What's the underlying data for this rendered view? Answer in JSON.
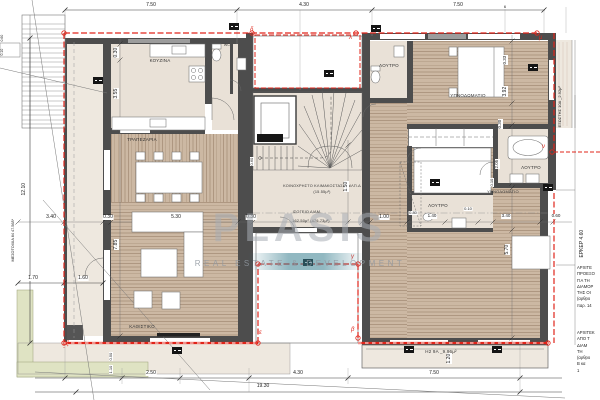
{
  "watermark": {
    "name": "PLASIS",
    "tagline": "REAL ESTATE & DEVELOPMENT"
  },
  "rooms": {
    "kitchen": "ΚΟΥΖΙΝΑ",
    "wc": "WC",
    "dining": "ΤΡΑΠΕΖΑΡΙΑ",
    "living": "ΚΑΘΙΣΤΙΚΟ",
    "bath1": "ΛΟΥΤΡΟ",
    "bath2": "ΛΟΥΤΡΟ",
    "bath3": "ΛΟΥΤΡΟ",
    "bedroom1": "ΥΠΝΟΔΩΜΑΤΙΟ",
    "bedroom2": "ΥΠΝΟΔΩΜΑΤΙΟ"
  },
  "areas": {
    "stair_line1": "ΚΟΙΝΟΧΡΗΣΤΟ ΚΛΙΜΑΚΟΣΤΑΣΙΟ ΚΛΠ.Δ",
    "stair_line2": "(15.55μ²)",
    "floor_line1": "ΙΣΟΓΕΙΟ ΔΙΑΜ.",
    "floor_line2": "162.50μ² (479.73μ²)",
    "balcony_east": "ΕΞΩΣΤΗΣ 10Α _2.92μ²",
    "balcony_south": "Η2 9Α _9.96μ²",
    "erker": "ΕΡΚΕΡ 4.60",
    "party_wall": "ΜΕΣΟΤΟΙΧΙΑ 84 47.56δ*"
  },
  "dims": {
    "top1": "7.50",
    "top2": "4.30",
    "top3": "7.50",
    "t6": "6",
    "l1": "12.10",
    "l2": "3.40",
    "l3": "1.70",
    "l4": "1.60",
    "k1": "0.30",
    "k2": "3.55",
    "d1": "0.30",
    "d2": "5.30",
    "d3": "7.85",
    "d4": "0.30",
    "c1": "1.50",
    "c2": "1.00",
    "c3": "0.60",
    "r1": "0.33",
    "r2": "3.92",
    "r3": "0.30",
    "r4": "2.05",
    "r5": "0.10",
    "r6": "5.70",
    "r7": "3.40",
    "r8": "0.60",
    "r9": "0.10",
    "r10": "1.40",
    "r11": "0.80",
    "b1": "2.50",
    "b2": "4.30",
    "b3": "7.50",
    "b4": "19.30",
    "b5": "1.20",
    "y1": "0.50",
    "y2": "1.10",
    "e1": "0.60",
    "e2": "0.10"
  },
  "markers": {
    "lambda": "λ",
    "mu": "μ",
    "nu": "ν",
    "gamma": "γ",
    "beta": "β",
    "epsilon": "ε",
    "zeta": "ζ",
    "delta": "δ",
    "omicron": "ο"
  },
  "notes1": [
    "ΑΡΧΙΤΕ",
    "ΠΡΟΕΞΟ",
    "ΓΙΑ ΤΗ",
    "ΔΙΑΜΟΡ",
    "ΤΗΣ ΟΙ",
    "(αρθρο",
    "παρ. 14"
  ],
  "notes2": [
    "ΑΡΧΙΤΕΚ",
    "ΑΠΟ Τ",
    "ΔΙΑΜ",
    "ΤΗ",
    "(αρθρο",
    "Β κα",
    "1"
  ]
}
